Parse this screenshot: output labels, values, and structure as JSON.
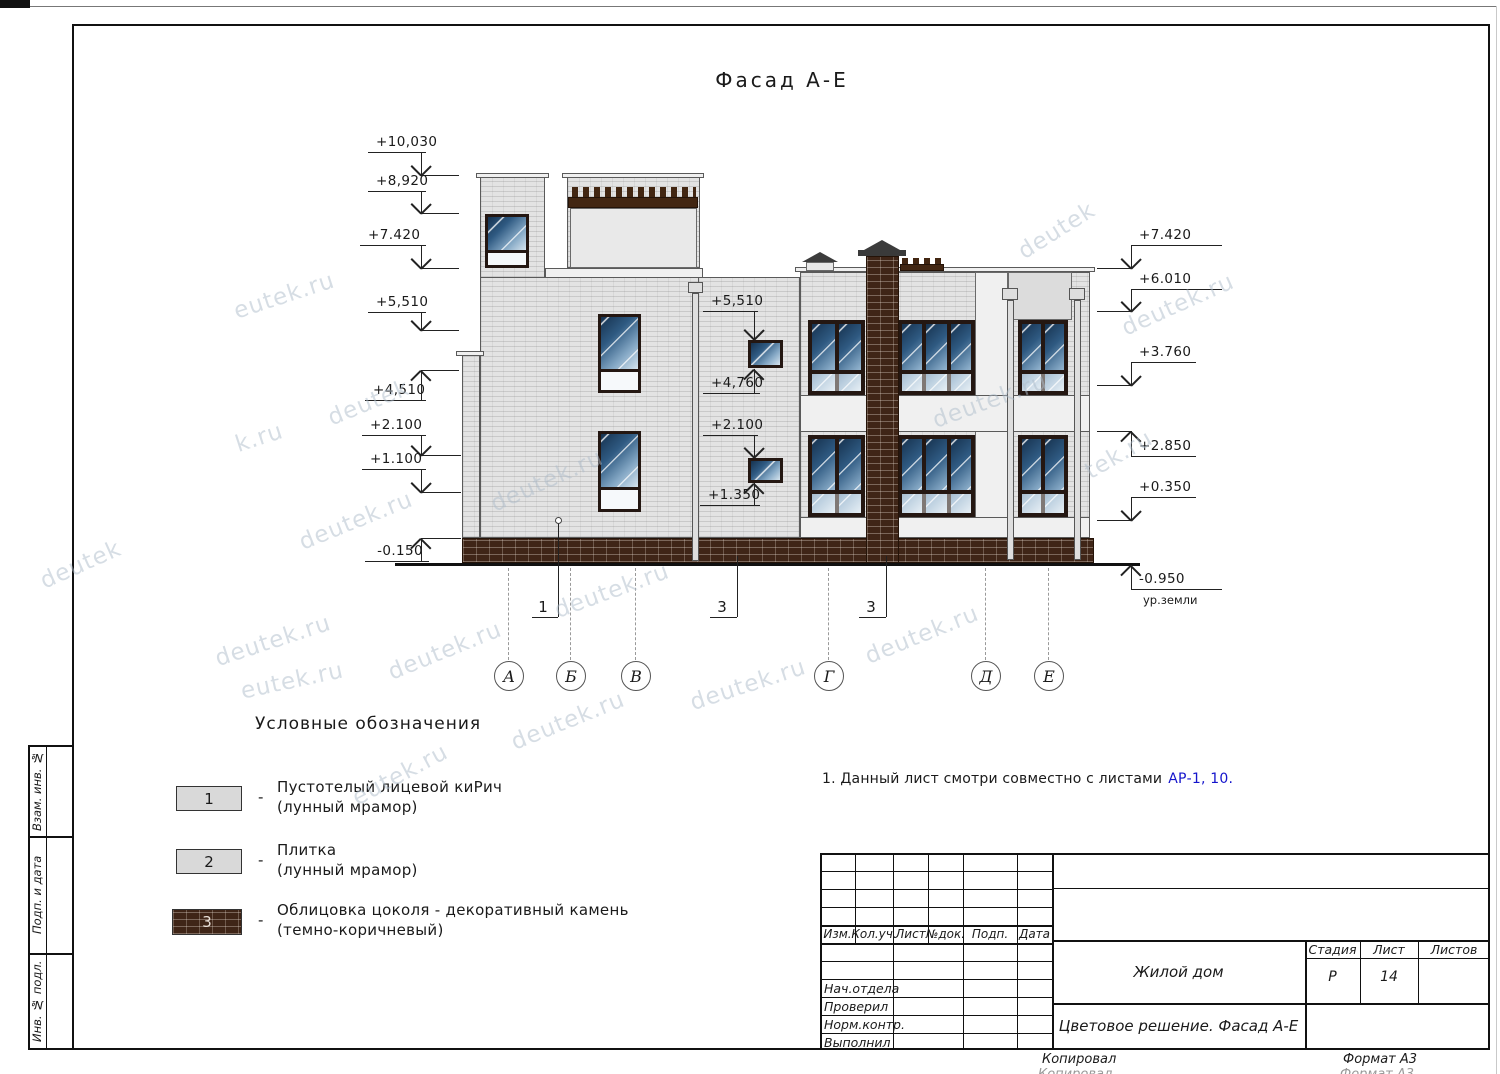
{
  "title": "Фасад А-Е",
  "note": {
    "text": "1. Данный лист смотри совместно с листами",
    "link": "АР-1, 10."
  },
  "legend": {
    "header": "Условные обозначения",
    "dash": "-",
    "items": [
      {
        "num": "1",
        "line1": "Пустотелый лицевой киРич",
        "line2": "(лунный мрамор)"
      },
      {
        "num": "2",
        "line1": "Плитка",
        "line2": "(лунный мрамор)"
      },
      {
        "num": "3",
        "line1": "Облицовка цоколя - декоративный камень",
        "line2": "(темно-коричневый)"
      }
    ]
  },
  "elevation_marks": [
    {
      "label": "+10,030",
      "tip": [
        421,
        175
      ],
      "dir": "down",
      "shelf": [
        368,
        426,
        152
      ],
      "level": [
        421,
        459
      ],
      "align": "right"
    },
    {
      "label": "+8,920",
      "tip": [
        421,
        213
      ],
      "dir": "down",
      "shelf": [
        368,
        426,
        191
      ],
      "level": [
        421,
        459
      ],
      "align": "right"
    },
    {
      "label": "+7.420",
      "tip": [
        421,
        268
      ],
      "dir": "down",
      "shelf": [
        360,
        426,
        245
      ],
      "level": [
        421,
        459
      ],
      "align": "right"
    },
    {
      "label": "+5,510",
      "tip": [
        421,
        330
      ],
      "dir": "down",
      "shelf": [
        368,
        426,
        312
      ],
      "level": [
        421,
        459
      ],
      "align": "right"
    },
    {
      "label": "+4,510",
      "tip": [
        421,
        370
      ],
      "dir": "up",
      "shelf": [
        365,
        426,
        400
      ],
      "level": [
        421,
        459
      ],
      "align": "right"
    },
    {
      "label": "+2.100",
      "tip": [
        421,
        455
      ],
      "dir": "down",
      "shelf": [
        362,
        426,
        435
      ],
      "level": [
        421,
        461
      ],
      "align": "right"
    },
    {
      "label": "+1.100",
      "tip": [
        421,
        492
      ],
      "dir": "down",
      "shelf": [
        362,
        426,
        469
      ],
      "level": [
        421,
        461
      ],
      "align": "right"
    },
    {
      "label": "-0.150",
      "tip": [
        421,
        538
      ],
      "dir": "up",
      "shelf": [
        365,
        429,
        561
      ],
      "level": [
        421,
        461
      ],
      "align": "right"
    },
    {
      "label": "+5,510",
      "tip": [
        754,
        339
      ],
      "dir": "down",
      "shelf": [
        703,
        758,
        311
      ],
      "level": null,
      "align": "right"
    },
    {
      "label": "+4,760",
      "tip": [
        754,
        369
      ],
      "dir": "up",
      "shelf": [
        703,
        760,
        393
      ],
      "level": null,
      "align": "right"
    },
    {
      "label": "+2.100",
      "tip": [
        754,
        457
      ],
      "dir": "down",
      "shelf": [
        703,
        758,
        435
      ],
      "level": null,
      "align": "right"
    },
    {
      "label": "+1.350",
      "tip": [
        754,
        483
      ],
      "dir": "up",
      "shelf": [
        700,
        760,
        505
      ],
      "level": null,
      "align": "right"
    },
    {
      "label": "+7.420",
      "tip": [
        1131,
        268
      ],
      "dir": "down",
      "shelf": [
        1131,
        1222,
        245
      ],
      "level": [
        1097,
        1131
      ],
      "align": "left"
    },
    {
      "label": "+6.010",
      "tip": [
        1131,
        311
      ],
      "dir": "down",
      "shelf": [
        1131,
        1222,
        289
      ],
      "level": [
        1097,
        1131
      ],
      "align": "left"
    },
    {
      "label": "+3.760",
      "tip": [
        1131,
        385
      ],
      "dir": "down",
      "shelf": [
        1131,
        1196,
        362
      ],
      "level": [
        1097,
        1131
      ],
      "align": "left"
    },
    {
      "label": "+2.850",
      "tip": [
        1131,
        431
      ],
      "dir": "up",
      "shelf": [
        1131,
        1196,
        456
      ],
      "level": [
        1097,
        1131
      ],
      "align": "left"
    },
    {
      "label": "+0.350",
      "tip": [
        1131,
        520
      ],
      "dir": "down",
      "shelf": [
        1131,
        1196,
        497
      ],
      "level": [
        1097,
        1131
      ],
      "align": "left"
    },
    {
      "label": "-0.950",
      "tip": [
        1131,
        565
      ],
      "dir": "up",
      "shelf": [
        1131,
        1222,
        589
      ],
      "level": null,
      "align": "left",
      "sub": "ур.земли"
    }
  ],
  "axes": {
    "circle_top": 661,
    "line_top": 568,
    "items": [
      {
        "label": "А",
        "x": 508
      },
      {
        "label": "Б",
        "x": 570
      },
      {
        "label": "В",
        "x": 635
      },
      {
        "label": "Г",
        "x": 828
      },
      {
        "label": "Д",
        "x": 985
      },
      {
        "label": "Е",
        "x": 1048
      }
    ]
  },
  "callouts": [
    {
      "label": "1",
      "cx": 543,
      "ty": 598,
      "shelf": [
        532,
        558,
        617
      ],
      "leader_x": 558,
      "leader_y1": 521,
      "dot": true
    },
    {
      "label": "3",
      "cx": 722,
      "ty": 598,
      "shelf": [
        710,
        737,
        617
      ],
      "leader_x": 737,
      "leader_y1": 556,
      "dot": false
    },
    {
      "label": "3",
      "cx": 871,
      "ty": 598,
      "shelf": [
        859,
        886,
        617
      ],
      "leader_x": 886,
      "leader_y1": 556,
      "dot": false
    }
  ],
  "stamp": {
    "header_cols": [
      "Изм.",
      "Кол.уч.",
      "Лист",
      "№док.",
      "Подп.",
      "Дата"
    ],
    "person_rows": [
      "Нач.отдела",
      "Проверил",
      "Норм.контр.",
      "Выполнил"
    ],
    "project": "Жилой дом",
    "doc_title": "Цветовое решение. Фасад А-Е",
    "stage_cols": [
      "Стадия",
      "Лист",
      "Листов"
    ],
    "stage_values": [
      "Р",
      "14",
      ""
    ]
  },
  "sidebar": [
    "Взам. инв. №",
    "Подп. и дата",
    "Инв. № подл."
  ],
  "footer": {
    "copied": "Копировал",
    "format": "Формат А3"
  },
  "watermarks": [
    {
      "t": "eutek.ru",
      "x": 232,
      "y": 283,
      "r": -18
    },
    {
      "t": "deutek",
      "x": 326,
      "y": 390,
      "r": -22
    },
    {
      "t": "k.ru",
      "x": 235,
      "y": 425,
      "r": -18
    },
    {
      "t": "deutek.ru",
      "x": 296,
      "y": 508,
      "r": -22
    },
    {
      "t": "deutek.ru",
      "x": 487,
      "y": 468,
      "r": -24
    },
    {
      "t": "deutek.ru",
      "x": 552,
      "y": 578,
      "r": -20
    },
    {
      "t": "deutek.ru",
      "x": 213,
      "y": 628,
      "r": -18
    },
    {
      "t": "deutek.ru",
      "x": 385,
      "y": 638,
      "r": -22
    },
    {
      "t": "eutek.ru",
      "x": 240,
      "y": 668,
      "r": -12
    },
    {
      "t": "deutek.ru",
      "x": 688,
      "y": 672,
      "r": -18
    },
    {
      "t": "deutek.ru",
      "x": 862,
      "y": 622,
      "r": -22
    },
    {
      "t": "deutek.ru",
      "x": 508,
      "y": 708,
      "r": -22
    },
    {
      "t": "eutek.ru",
      "x": 348,
      "y": 762,
      "r": -28
    },
    {
      "t": "deutek",
      "x": 1014,
      "y": 218,
      "r": -32
    },
    {
      "t": "deutek.ru",
      "x": 1118,
      "y": 292,
      "r": -24
    },
    {
      "t": "tek.ru",
      "x": 1082,
      "y": 442,
      "r": -30
    },
    {
      "t": "deutek",
      "x": 38,
      "y": 552,
      "r": -24
    },
    {
      "t": "deutek.ru",
      "x": 930,
      "y": 388,
      "r": -20
    }
  ],
  "colors": {
    "link_blue": "#1414cc",
    "wall_gray": "#e3e3e3",
    "plinth_brown": "#3f2517",
    "frame_dark": "#241712",
    "glass_blue": "#2f5a82",
    "watermark": "#aebdcb"
  }
}
